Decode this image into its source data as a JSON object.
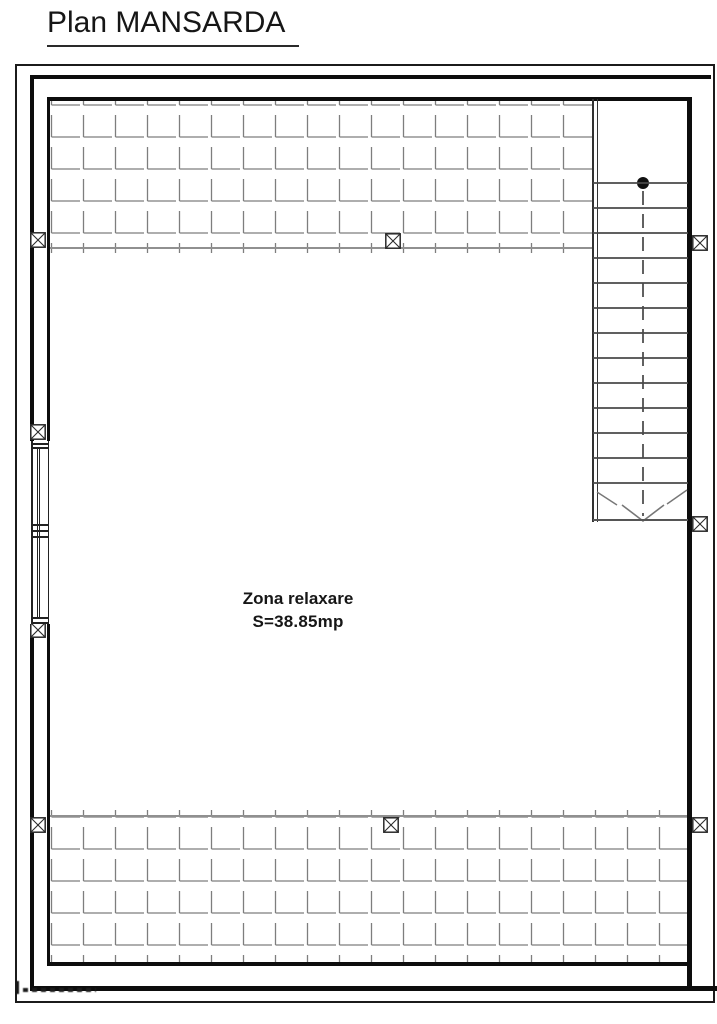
{
  "page": {
    "title": "Plan MANSARDA"
  },
  "floor_plan": {
    "room": {
      "label": "Zona relaxare",
      "area_label": "S=38.85mp"
    },
    "stairs": {
      "step_count": 13,
      "start_dot": true
    },
    "column_marker_count": 9,
    "colors": {
      "wall": "#0d0d0d",
      "frame": "#1b1b1b",
      "hatch_line": "#7e7e7e",
      "step_line": "#4a4a4a",
      "background": "#ffffff"
    }
  }
}
